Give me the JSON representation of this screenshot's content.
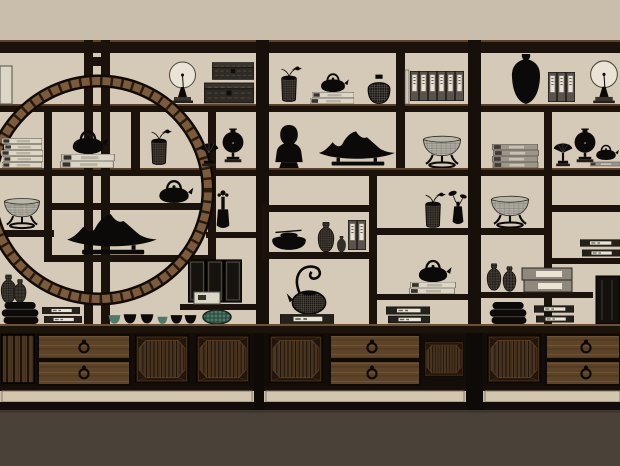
{
  "viewport": {
    "width": 620,
    "height": 466,
    "description": "3D rendered elevation of a Chinese antique-style display wall shelf (bogu shelf) with a circular moon-gate lattice, silhouetted curios, and base cabinets with ring-pull drawers"
  },
  "colors": {
    "wall": "#c8beab",
    "bay": "#d5c9b7",
    "floor": "#4a4238",
    "wood": "#1b120b",
    "woodLight": "#5e4329",
    "ring": "#7a5b3c",
    "ink": "#0c0a08",
    "paper": "#e9e4d6",
    "paperCream": "#dcd6c6",
    "bookGray": "#9d968a",
    "teal": "#4d7a69",
    "drawerWood": "#5d4328",
    "panelWood": "#2c1d0e",
    "plinth": "#d3c6ae",
    "fileGray": "#5a534c"
  },
  "scene": {
    "shelf_unit": {
      "bays": 3,
      "left_bay_feature": "circular moon-gate lattice ring",
      "material": "dark stained wood"
    },
    "cabinets": [
      {
        "position": "left",
        "drawers": 2,
        "pulls": "ring",
        "panels": "ribbed octagonal coffers"
      },
      {
        "position": "center",
        "drawers": 2,
        "pulls": "ring",
        "panels": "ribbed octagonal coffers"
      },
      {
        "position": "right",
        "drawers": 2,
        "pulls": "ring",
        "panels": "ribbed octagonal coffers"
      }
    ],
    "objects": [
      {
        "id": "round-mirror-1",
        "label": "round mirror on stand"
      },
      {
        "id": "wooden-chest-stack",
        "label": "stacked wooden chests"
      },
      {
        "id": "book-stack-cream-1",
        "label": "stack of cream books"
      },
      {
        "id": "teapot-on-books-1",
        "label": "iron teapot on books"
      },
      {
        "id": "sprig-jar-1",
        "label": "lidded jar with bird and sprig"
      },
      {
        "id": "fan-ornament-1",
        "label": "fan ornament on stand"
      },
      {
        "id": "coin-vase-1",
        "label": "coin-shaped vase on stand"
      },
      {
        "id": "crackle-bowl-1",
        "label": "crackle-glaze bowl on carved stand"
      },
      {
        "id": "scholar-rock-1",
        "label": "mountain scholar rock on stand"
      },
      {
        "id": "teapot-2",
        "label": "iron teapot"
      },
      {
        "id": "flower-vase",
        "label": "slender vase with flower"
      },
      {
        "id": "screen-panels",
        "label": "three dark panels"
      },
      {
        "id": "white-book",
        "label": "white book"
      },
      {
        "id": "celadon-basket",
        "label": "woven celadon basket"
      },
      {
        "id": "teacup-row",
        "label": "row of six teacups"
      },
      {
        "id": "bowl-stack-1",
        "label": "pile of stacked black bowls"
      },
      {
        "id": "book-stack-dark-1",
        "label": "dark books with white labels"
      },
      {
        "id": "black-vase-pair-left",
        "label": "pair of black vases"
      },
      {
        "id": "sprig-jar-2",
        "label": "lidded jar with bird and sprig"
      },
      {
        "id": "teapot-on-books-2",
        "label": "iron teapot on books"
      },
      {
        "id": "woven-jar",
        "label": "round woven jar"
      },
      {
        "id": "book-files-1",
        "label": "row of six book files"
      },
      {
        "id": "buddha-bust",
        "label": "buddha head bust"
      },
      {
        "id": "scholar-rock-2",
        "label": "mountain scholar rock on stand"
      },
      {
        "id": "crackle-bowl-2",
        "label": "crackle-glaze bowl on carved stand"
      },
      {
        "id": "lidded-low-jar",
        "label": "low lidded jar with scoop"
      },
      {
        "id": "gourd-vases-mid",
        "label": "woven gourd vases"
      },
      {
        "id": "book-files-2",
        "label": "pair of book files"
      },
      {
        "id": "sprig-jar-3",
        "label": "lidded jar with bird sprig"
      },
      {
        "id": "lotus-vase",
        "label": "vase with lotus leaves"
      },
      {
        "id": "teapot-on-books-3",
        "label": "iron teapot on books"
      },
      {
        "id": "book-stack-dark-2",
        "label": "dark books with white labels"
      },
      {
        "id": "curl-kettle",
        "label": "kettle with curled overhead handle"
      },
      {
        "id": "meiping-vase",
        "label": "black meiping vase"
      },
      {
        "id": "book-files-3",
        "label": "row of three book files"
      },
      {
        "id": "round-mirror-2",
        "label": "round mirror on stand"
      },
      {
        "id": "book-stack-gray",
        "label": "stack of gray books"
      },
      {
        "id": "fan-ornament-2",
        "label": "fan ornament on stand"
      },
      {
        "id": "coin-vase-2",
        "label": "coin-shaped vase on stand"
      },
      {
        "id": "teapot-on-books-4",
        "label": "small teapot on books"
      },
      {
        "id": "crackle-bowl-3",
        "label": "crackle-glaze bowl on carved stand"
      },
      {
        "id": "book-stack-dark-3",
        "label": "dark books with white labels"
      },
      {
        "id": "gourd-vase-pair-right",
        "label": "pair of woven gourd vases"
      },
      {
        "id": "book-boxes-gray",
        "label": "gray book boxes with labels"
      },
      {
        "id": "pot-stack",
        "label": "pile of stacked black pots"
      },
      {
        "id": "book-stack-dark-4",
        "label": "dark books with white labels"
      },
      {
        "id": "dark-panel",
        "label": "tall dark panel"
      }
    ]
  }
}
